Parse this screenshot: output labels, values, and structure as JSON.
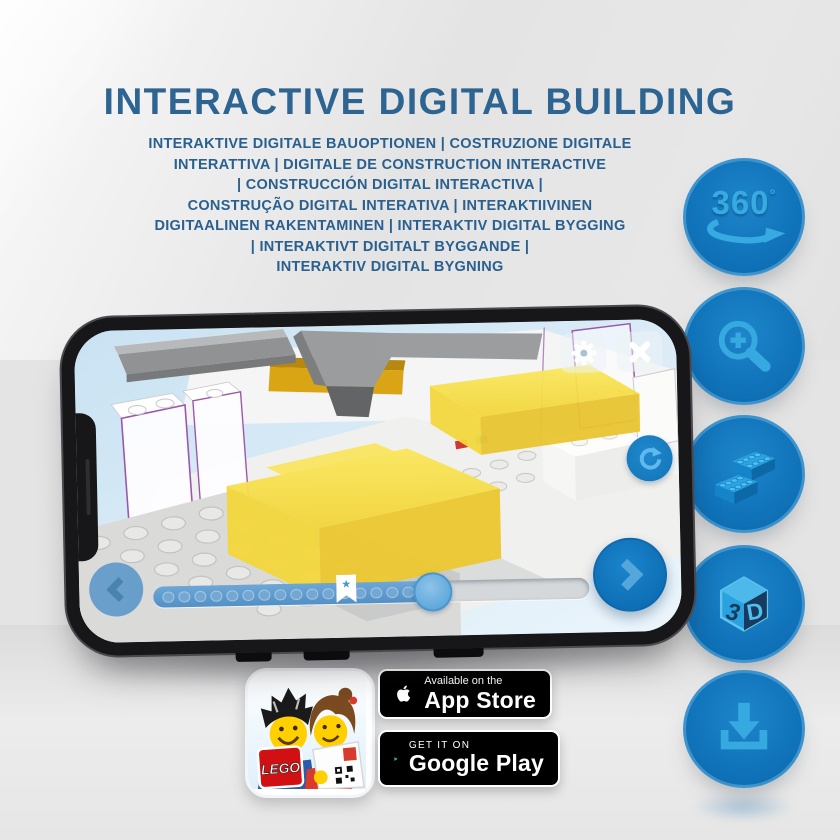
{
  "page": {
    "title": "INTERACTIVE DIGITAL BUILDING",
    "subtitle_lines": [
      "INTERAKTIVE DIGITALE BAUOPTIONEN | COSTRUZIONE DIGITALE",
      "INTERATTIVA | DIGITALE DE CONSTRUCTION INTERACTIVE",
      "| CONSTRUCCIÓN DIGITAL INTERACTIVA |",
      "CONSTRUÇÃO DIGITAL INTERATIVA | INTERAKTIIVINEN",
      "DIGITAALINEN RAKENTAMINEN | INTERAKTIV DIGITAL BYGGING",
      "| INTERAKTIVT DIGITALT BYGGANDE |",
      "INTERAKTIV DIGITAL BYGNING"
    ]
  },
  "features": [
    {
      "id": "rotate-360",
      "label": "360",
      "degree": "°"
    },
    {
      "id": "zoom-in"
    },
    {
      "id": "bricks"
    },
    {
      "id": "view-3d",
      "digit": "3",
      "letter": "D"
    },
    {
      "id": "download"
    }
  ],
  "phone_app": {
    "slider": {
      "progress_pct": 63,
      "bookmark_pct": 42,
      "step_dots": 18
    }
  },
  "badges": {
    "lego_app": {
      "logo": "LEGO"
    },
    "app_store": {
      "tagline": "Available on the",
      "store": "App Store"
    },
    "google_play": {
      "tagline": "GET IT ON",
      "store": "Google Play"
    }
  },
  "colors": {
    "title_blue": "#2d6492",
    "circle_blue": "#1073ba",
    "icon_blue": "#36a9e1",
    "highlight_yellow": "#f5d93f",
    "ghost_outline_purple": "#9c57ad"
  }
}
